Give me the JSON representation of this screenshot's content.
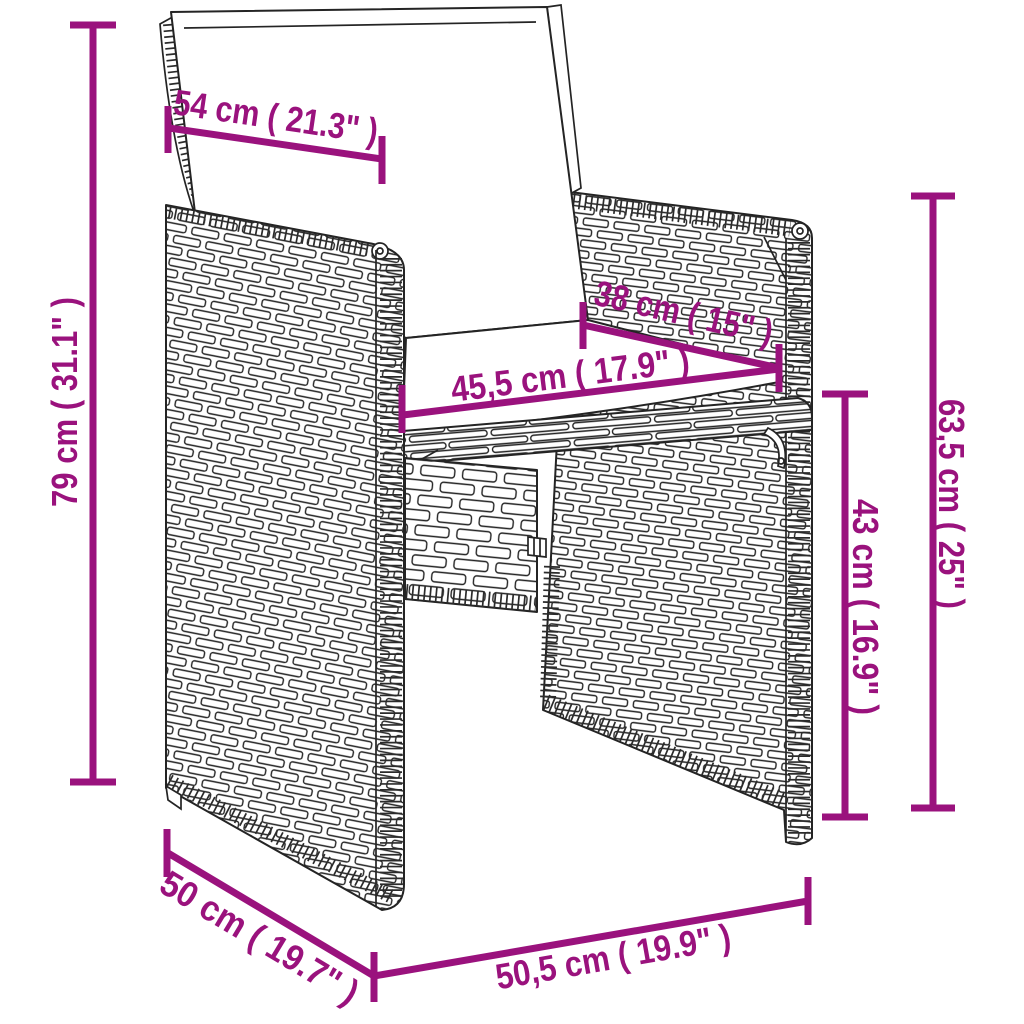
{
  "diagram": {
    "type": "product-dimension-diagram",
    "subject": "rattan-garden-chair-with-cushions"
  },
  "colors": {
    "accent": "#9A127D",
    "outline": "#242424",
    "background": "#FFFFFF"
  },
  "dimension_labels": {
    "back_cushion_width": "54 cm ( 21.3\" )",
    "total_height": "79 cm ( 31.1\" )",
    "seat_depth": "38 cm ( 15\" )",
    "seat_width": "45,5 cm ( 17.9\" )",
    "armrest_panel_height": "63,5 cm ( 25\" )",
    "seat_height": "43 cm ( 16.9\" )",
    "base_side_depth": "50 cm ( 19.7\" )",
    "base_front_width": "50,5 cm ( 19.9\" )"
  }
}
